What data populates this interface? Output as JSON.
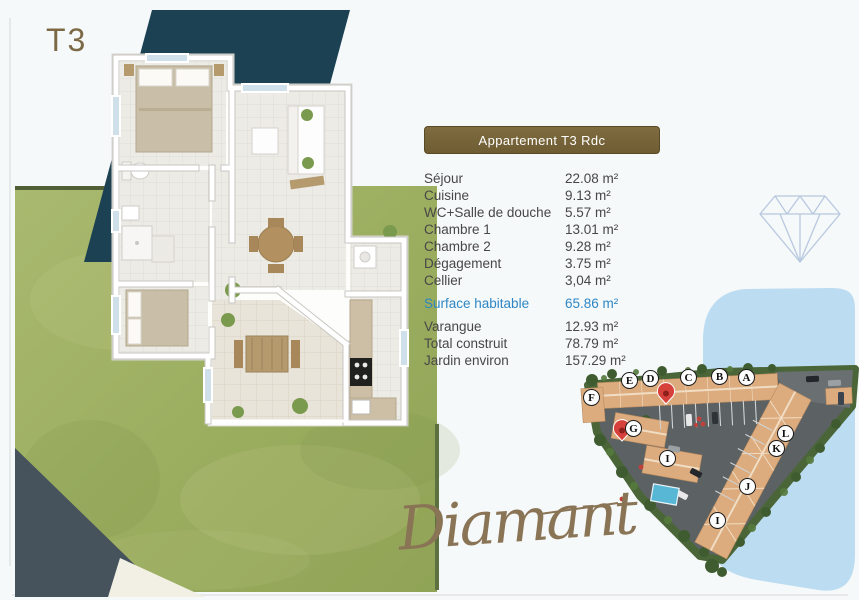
{
  "page": {
    "plan_type_label": "T3",
    "brand_script": "Diamant"
  },
  "info_panel": {
    "header": "Appartement T3 Rdc",
    "rooms": [
      {
        "label": "Séjour",
        "value": "22.08 m²"
      },
      {
        "label": "Cuisine",
        "value": "9.13 m²"
      },
      {
        "label": "WC+Salle de douche",
        "value": "5.57 m²"
      },
      {
        "label": "Chambre 1",
        "value": "13.01 m²"
      },
      {
        "label": "Chambre 2",
        "value": "9.28 m²"
      },
      {
        "label": "Dégagement",
        "value": "3.75 m²"
      },
      {
        "label": "Cellier",
        "value": "3,04 m²"
      }
    ],
    "highlight": {
      "label": "Surface habitable",
      "value": "65.86 m²"
    },
    "extras": [
      {
        "label": "Varangue",
        "value": "12.93 m²"
      },
      {
        "label": "Total construit",
        "value": "78.79 m²"
      },
      {
        "label": "Jardin environ",
        "value": "157.29 m²"
      }
    ]
  },
  "site_plan": {
    "units": [
      {
        "letter": "F"
      },
      {
        "letter": "E"
      },
      {
        "letter": "D"
      },
      {
        "letter": "C"
      },
      {
        "letter": "B"
      },
      {
        "letter": "A"
      },
      {
        "letter": "G"
      },
      {
        "letter": "I"
      },
      {
        "letter": "L"
      },
      {
        "letter": "K"
      },
      {
        "letter": "J"
      },
      {
        "letter": "I"
      }
    ],
    "pin_icon": "map-pin-icon",
    "pin_count": 2
  },
  "icons": {
    "diamond_outline": "diamond-outline-icon"
  },
  "colors": {
    "accent_brown": "#7b683c",
    "highlight_blue": "#2e86c4",
    "teal_shape": "#1b4152",
    "slate_shape": "#46525c",
    "grass_green": "#9fb166",
    "swoosh_blue": "#bcdcf2",
    "pin_red": "#d6423b",
    "script_gold": "#8a7456"
  }
}
